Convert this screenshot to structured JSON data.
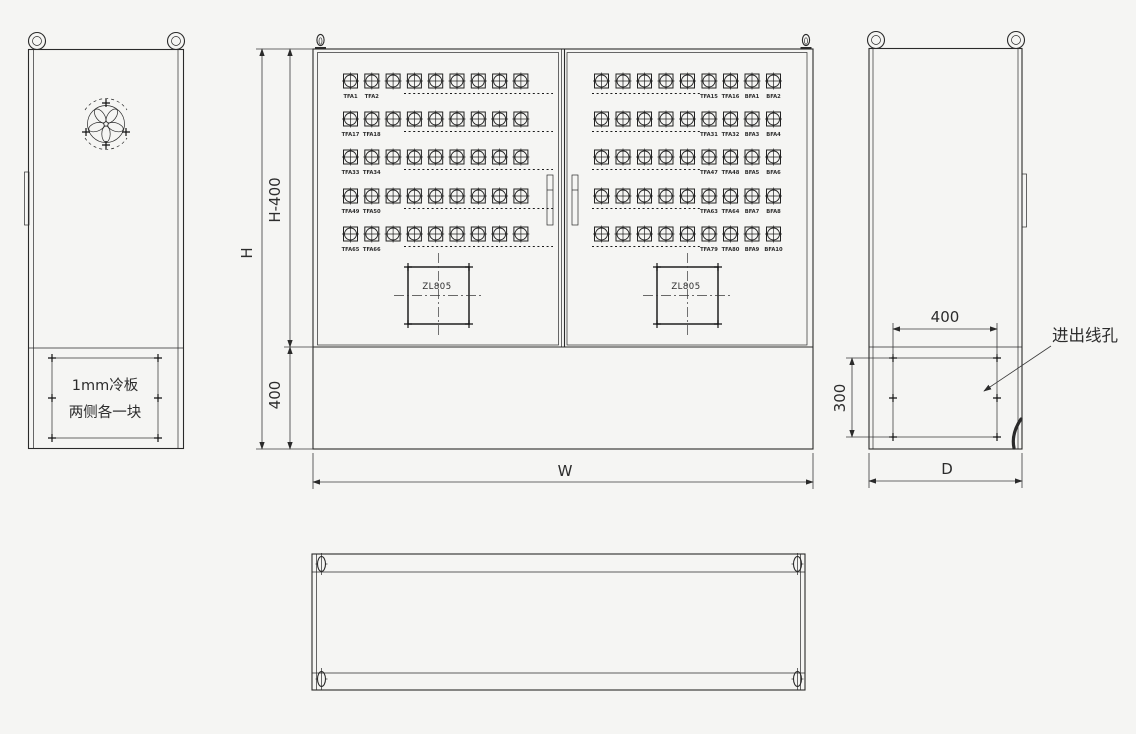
{
  "colors": {
    "background": "#f5f5f3",
    "line": "#2a2a2a",
    "text": "#2c2c2c"
  },
  "left_view": {
    "note_line1": "1mm冷板",
    "note_line2": "两侧各一块"
  },
  "front_view": {
    "dims": {
      "height_total": "H",
      "height_upper": "H-400",
      "height_lower": "400",
      "width": "W"
    },
    "connectors_per_row_visible": 9,
    "left_door_rows": [
      {
        "labels": [
          "TFA1",
          "TFA2"
        ]
      },
      {
        "labels": [
          "TFA17",
          "TFA18"
        ]
      },
      {
        "labels": [
          "TFA33",
          "TFA34"
        ]
      },
      {
        "labels": [
          "TFA49",
          "TFA50"
        ]
      },
      {
        "labels": [
          "TFA65",
          "TFA66"
        ]
      }
    ],
    "right_door_rows": [
      {
        "labels": [
          "TFA15",
          "TFA16",
          "BFA1",
          "BFA2"
        ]
      },
      {
        "labels": [
          "TFA31",
          "TFA32",
          "BFA3",
          "BFA4"
        ]
      },
      {
        "labels": [
          "TFA47",
          "TFA48",
          "BFA5",
          "BFA6"
        ]
      },
      {
        "labels": [
          "TFA63",
          "TFA64",
          "BFA7",
          "BFA8"
        ]
      },
      {
        "labels": [
          "TFA79",
          "TFA80",
          "BFA9",
          "BFA10"
        ]
      }
    ],
    "cutout_label": "ZL805"
  },
  "side_view": {
    "dims": {
      "hole_width": "400",
      "hole_height": "300",
      "depth": "D"
    },
    "callout": "进出线孔"
  }
}
